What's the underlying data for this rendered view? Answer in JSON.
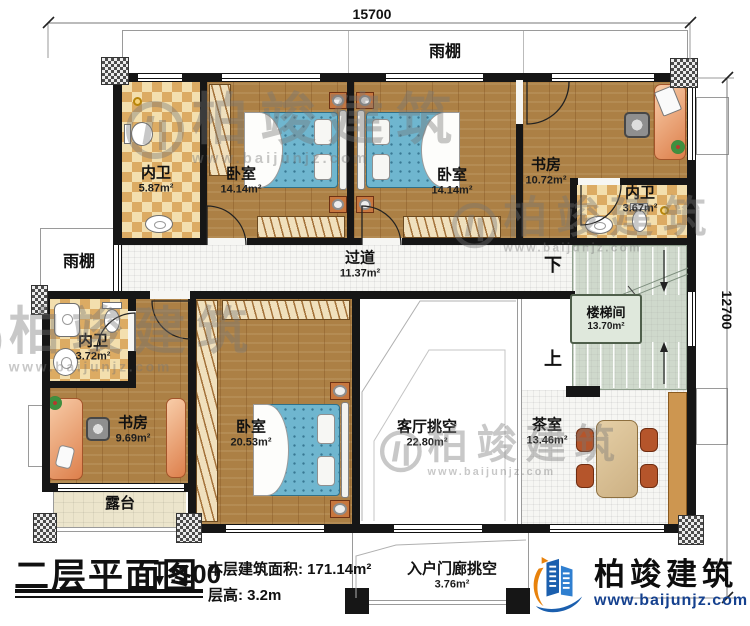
{
  "dimensions": {
    "top": "15700",
    "right": "12700"
  },
  "canopies": {
    "top": "雨棚",
    "left": "雨棚"
  },
  "rooms": {
    "bath_top": {
      "name": "内卫",
      "area": "5.87m²"
    },
    "bedroom_top_left": {
      "name": "卧室",
      "area": "14.14m²"
    },
    "bedroom_top_right": {
      "name": "卧室",
      "area": "14.14m²"
    },
    "study_top": {
      "name": "书房",
      "area": "10.72m²"
    },
    "bath_right": {
      "name": "内卫",
      "area": "3.67m²"
    },
    "corridor": {
      "name": "过道",
      "area": "11.37m²"
    },
    "stairwell": {
      "name": "楼梯间",
      "area": "13.70m²"
    },
    "bath_left": {
      "name": "内卫",
      "area": "3.72m²"
    },
    "study_left": {
      "name": "书房",
      "area": "9.69m²"
    },
    "bedroom_large": {
      "name": "卧室",
      "area": "20.53m²"
    },
    "terrace": {
      "name": "露台"
    },
    "living_void": {
      "name": "客厅挑空",
      "area": "22.80m²"
    },
    "tea_room": {
      "name": "茶室",
      "area": "13.46m²"
    },
    "porch_void": {
      "name": "入户门廊挑空",
      "area": "3.76m²"
    }
  },
  "stairs": {
    "down": "下",
    "up": "上"
  },
  "title_block": {
    "title": "二层平面图",
    "scale": ":100",
    "area_label": "本层建筑面积:",
    "area_value": "171.14m²",
    "floor_height_label": "层高:",
    "floor_height_value": "3.2m"
  },
  "brand": {
    "name": "柏竣建筑",
    "url": "www.baijunjz.com"
  },
  "watermark": {
    "name": "柏竣建筑",
    "url": "www.baijunjz.com"
  },
  "colors": {
    "wall": "#161616",
    "wood": "#ac8045",
    "stair": "#cfd9cc",
    "bed": "#6fb6cf",
    "accent_orange": "#e8820c",
    "accent_blue": "#1b5fae"
  }
}
